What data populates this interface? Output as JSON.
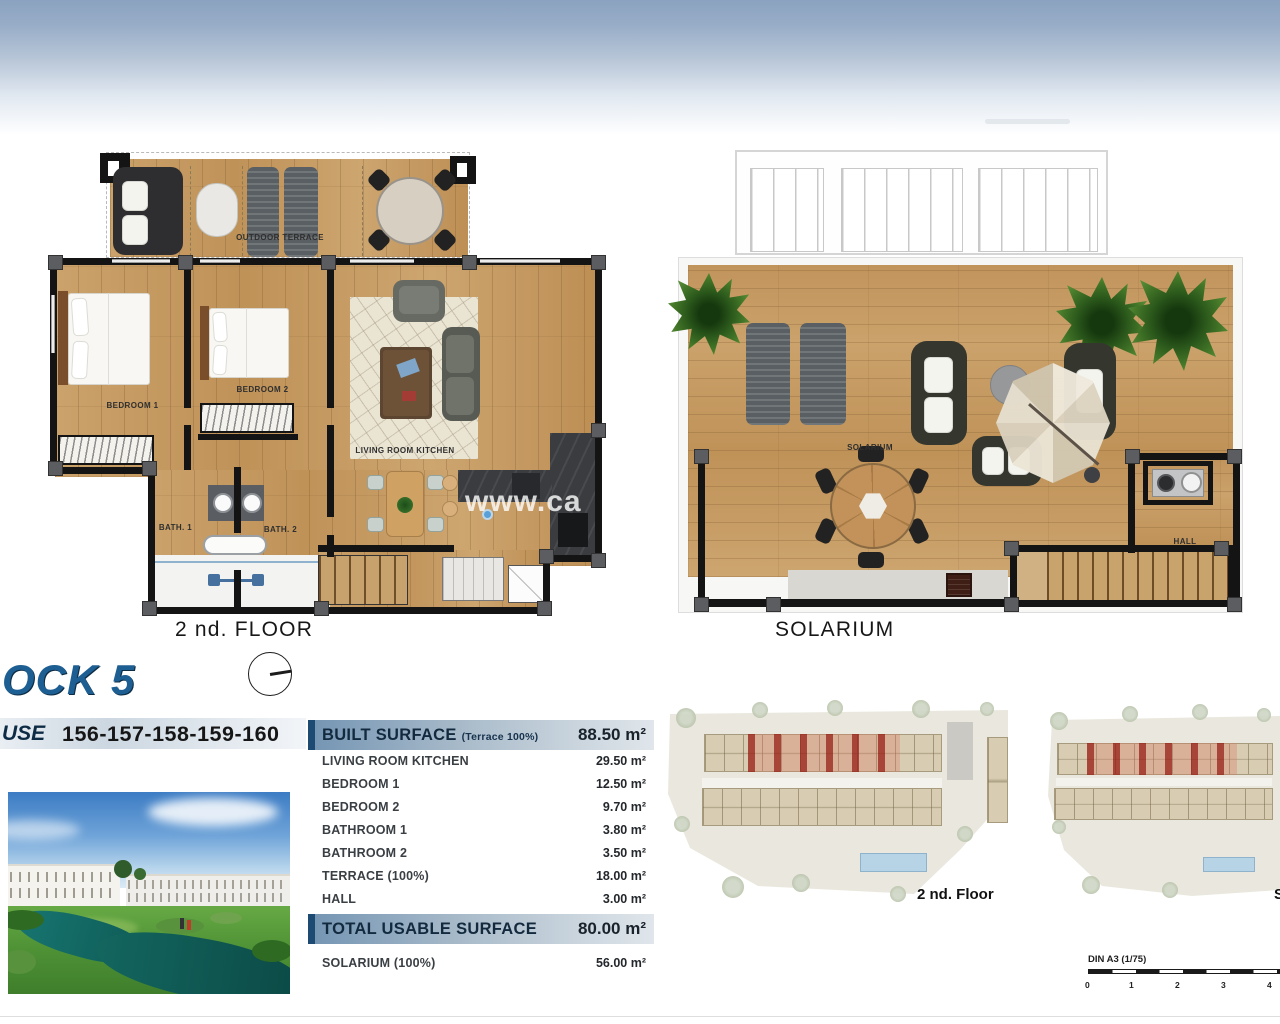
{
  "colors": {
    "sky_top": "#8ba3c0",
    "title_blue": "#1e5f93",
    "table_header_blue": "#7394b3",
    "table_header_bar": "#1d4a73",
    "wood": "#c79e67",
    "wall": "#141414",
    "red_highlight": "#a82820",
    "pool_blue": "#b7d3e6"
  },
  "floor_plan_2nd": {
    "title": "2 nd. FLOOR",
    "labels": {
      "terrace": "OUTDOOR TERRACE",
      "bedroom1": "BEDROOM 1",
      "bedroom2": "BEDROOM 2",
      "living": "LIVING ROOM KITCHEN",
      "bath1": "BATH. 1",
      "bath2": "BATH. 2"
    },
    "watermark": "www.ca"
  },
  "solarium_plan": {
    "title": "SOLARIUM",
    "labels": {
      "solarium": "SOLARIUM",
      "hall": "HALL"
    }
  },
  "block_info": {
    "block_title": "OCK 5",
    "house_label": "USE",
    "house_numbers": "156-157-158-159-160"
  },
  "surface_table": {
    "built": {
      "label": "BUILT SURFACE",
      "note": "(Terrace 100%)",
      "value": "88.50 m²"
    },
    "rows": [
      {
        "label": "LIVING ROOM KITCHEN",
        "value": "29.50 m²"
      },
      {
        "label": "BEDROOM 1",
        "value": "12.50 m²"
      },
      {
        "label": "BEDROOM 2",
        "value": "9.70 m²"
      },
      {
        "label": "BATHROOM 1",
        "value": "3.80 m²"
      },
      {
        "label": "BATHROOM 2",
        "value": "3.50 m²"
      },
      {
        "label": "TERRACE (100%)",
        "value": "18.00 m²"
      },
      {
        "label": "HALL",
        "value": "3.00 m²"
      }
    ],
    "total": {
      "label": "TOTAL USABLE SURFACE",
      "value": "80.00 m²"
    },
    "solarium_row": {
      "label": "SOLARIUM (100%)",
      "value": "56.00 m²"
    }
  },
  "site_plans": [
    {
      "label": "2 nd. Floor"
    },
    {
      "label": "S"
    }
  ],
  "scale_bar": {
    "label": "DIN A3 (1/75)",
    "ticks": [
      "0",
      "1",
      "2",
      "3",
      "4"
    ]
  }
}
